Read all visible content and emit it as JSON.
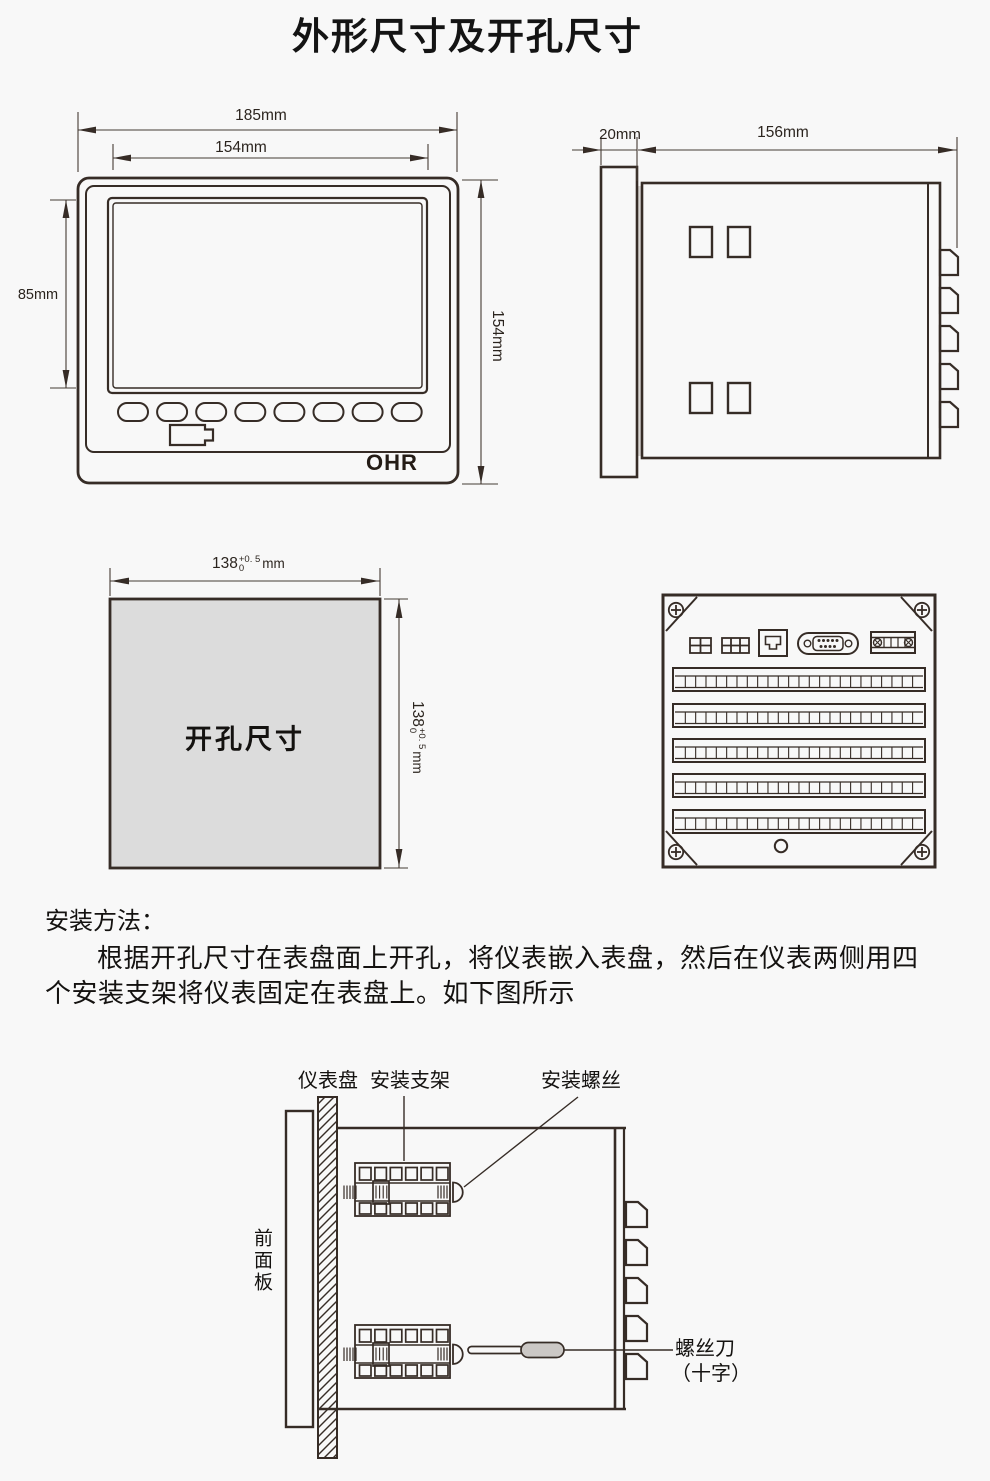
{
  "title": "外形尺寸及开孔尺寸",
  "colors": {
    "line": "#362c26",
    "background": "#f8f8f8",
    "cutout_fill": "#dcdcdc",
    "screwdriver_handle": "#cbc8c5",
    "panel_gap_shade": "#d9d6d3"
  },
  "front_view": {
    "brand": "OHR",
    "dims": {
      "outer_width": "185mm",
      "screen_width": "154mm",
      "screen_height": "85mm",
      "outer_height": "154mm"
    }
  },
  "side_view": {
    "dims": {
      "bezel_depth": "20mm",
      "body_depth": "156mm"
    }
  },
  "cutout_view": {
    "label": "开孔尺寸",
    "dim_value": "138",
    "tol_upper": "+0. 5",
    "tol_lower": "0",
    "unit": "mm"
  },
  "install_text": {
    "heading": "安装方法：",
    "line1": "根据开孔尺寸在表盘面上开孔，将仪表嵌入表盘，然后在仪表两侧用四",
    "line2": "个安装支架将仪表固定在表盘上。如下图所示"
  },
  "install_diagram": {
    "panel_label": "仪表盘",
    "bracket_label": "安装支架",
    "screw_label": "安装螺丝",
    "front_panel_label": "前面板",
    "screwdriver_label_line1": "螺丝刀",
    "screwdriver_label_line2": "（十字）"
  }
}
